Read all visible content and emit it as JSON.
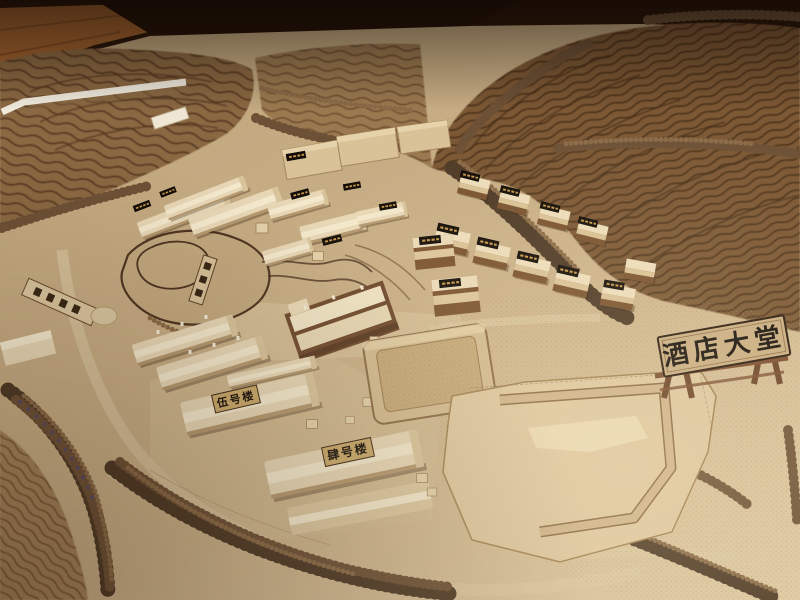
{
  "photo": {
    "type": "photograph of an architectural scale model (wooden sand table)",
    "subject": "hillside resort masterplan with laser-cut terraced contour hills, foam tree rows, cream building massing blocks, pool, hotel-lobby footprint and engraved name plaques",
    "setting": "model edge meets a wooden floor and dark backdrop at top of frame"
  },
  "signs": {
    "hotel_lobby": "酒店大堂",
    "building_five": "伍号楼",
    "building_four": "肆号楼"
  },
  "plaques": {
    "black_plaques": "many small black roof plaques with engraved gold characters (illegible at this scale)",
    "standing_sign": "small standing plaque by the lake with three engraved characters (illegible)",
    "fallen_plank": "loose engraved plank lying flat on the terrain at left (illegible)"
  },
  "palette": {
    "backdrop_dark": "#201208",
    "wood_floor": "#a2632e",
    "terrain": "#c9b086",
    "terrain_bright": "#decca4",
    "hill_left": "#8a6742",
    "hill_right": "#7b5936",
    "contour_line": "#54371f",
    "tree_dark": "#4e3a26",
    "building_wall": "#e7d7b6",
    "roof_brown": "#7a522f",
    "plaque_black": "#150e08",
    "plaque_gold": "#c69a4a",
    "plaque_wood": "#c9ad82",
    "ink": "#16100a"
  }
}
